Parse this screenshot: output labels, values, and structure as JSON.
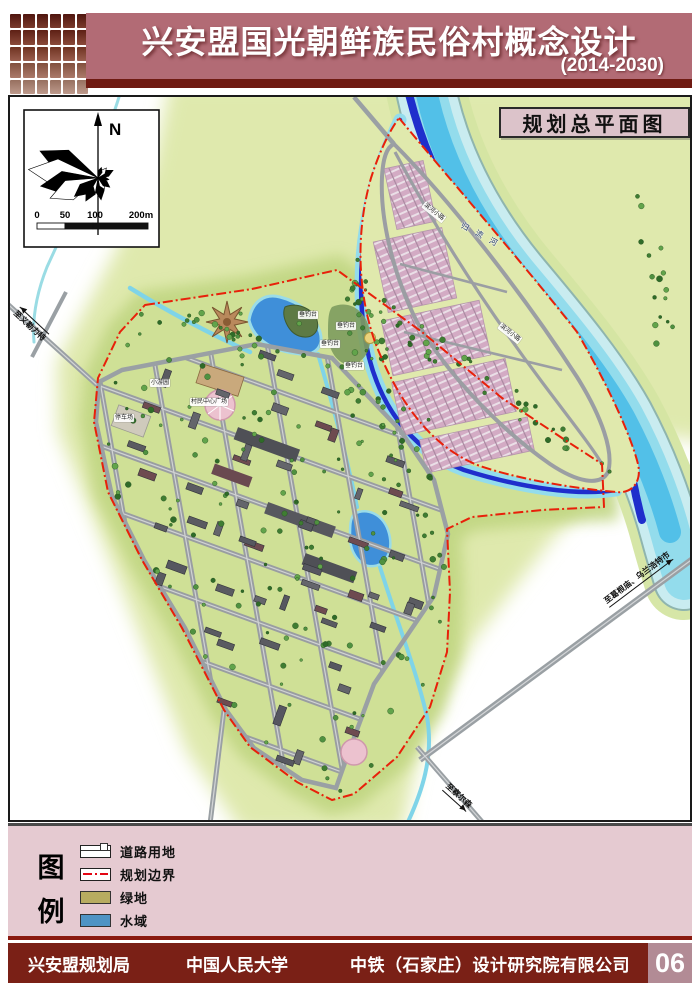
{
  "header": {
    "title": "兴安盟国光朝鲜族民俗村概念设计",
    "subtitle": "(2014-2030)"
  },
  "map": {
    "title_box": "规划总平面图",
    "compass_north": "N",
    "scale_ticks": [
      "0",
      "50",
      "100",
      "200m"
    ],
    "annotations": {
      "river_name": "归流河",
      "riverside_path_a": "滨河小路",
      "riverside_path_b": "滨河小路",
      "fishing_platforms": [
        "垂钓台",
        "垂钓台",
        "垂钓台",
        "垂钓台"
      ],
      "village_center_plaza": "村民中心广场",
      "small_garden": "小游园",
      "parking_lot": "停车场",
      "road_to_west": "至义勒力特",
      "road_to_northeast": "至葛根庙、乌兰浩特市",
      "road_to_south": "至察尔森"
    }
  },
  "legend": {
    "heading_top": "图",
    "heading_bottom": "例",
    "items": [
      {
        "label": "道路用地",
        "type": "road"
      },
      {
        "label": "规划边界",
        "type": "boundary",
        "color": "#e30613"
      },
      {
        "label": "绿地",
        "type": "green",
        "color": "#b7ac60"
      },
      {
        "label": "水域",
        "type": "water",
        "color": "#4e94c4"
      }
    ]
  },
  "footer": {
    "org_1": "兴安盟规划局",
    "org_2": "中国人民大学",
    "org_3": "中铁（石家庄）设计研究院有限公司",
    "page_number": "06"
  },
  "colors": {
    "header_band": "#b26b75",
    "header_strip": "#6f1a12",
    "legend_band": "#e5cad1",
    "footer_bar": "#7a2016",
    "boundary_red": "#e30613",
    "terrain_green": "#dfe9ad",
    "water_channel": "#1f2ecc",
    "river_cyan": "#93dcec"
  }
}
